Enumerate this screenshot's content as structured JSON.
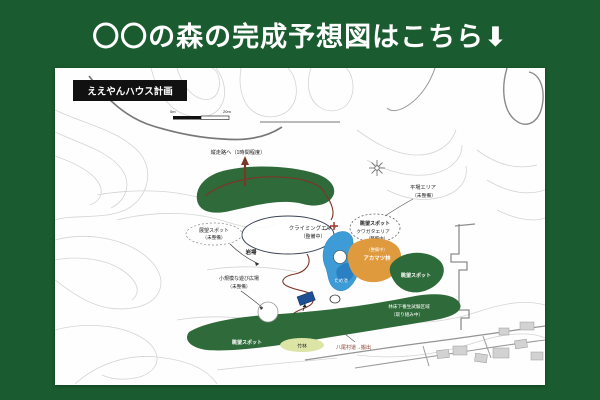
{
  "header": {
    "title": "〇〇の森の完成予想図はこちら⬇"
  },
  "map": {
    "plan_label": "ええやんハウス計画",
    "scale": {
      "left": "0m",
      "right": "20m"
    },
    "labels": {
      "ridge_trail": "縦走路へ（1時間程度）",
      "viewpoint_west": "展望スポット",
      "viewpoint_west_note": "（未整備）",
      "rock_area": "岩場",
      "climbing_area": "クライミングエリア",
      "climbing_area_note": "（整備中）",
      "flat_area": "平場エリア",
      "flat_area_note": "（未整備）",
      "viewpoint_east": "眺望スポット",
      "beetle_area": "クワガタエリア",
      "beetle_area_note": "（整備中）",
      "red_pine_note": "（整備中）",
      "red_pine": "アカマツ林",
      "pond": "ため池",
      "viewpoint_hill": "眺望スポット",
      "test_zone_line1": "林床下養生試験区域",
      "test_zone_line2": "（取り組み中）",
      "small_plaza_line1": "小規模な遊び広場",
      "small_plaza_line2": "（未整備）",
      "viewpoint_strip": "眺望スポット",
      "bamboo": "竹林",
      "road_note": "八尾村道→搬出"
    },
    "colors": {
      "header_bg": "#1a5c2f",
      "forest_green": "#2f6b3a",
      "orange_area": "#e09a3e",
      "pond_blue": "#3d9bd5",
      "trail_red": "#7b3628",
      "bamboo_yellow": "#dce4a6"
    }
  }
}
